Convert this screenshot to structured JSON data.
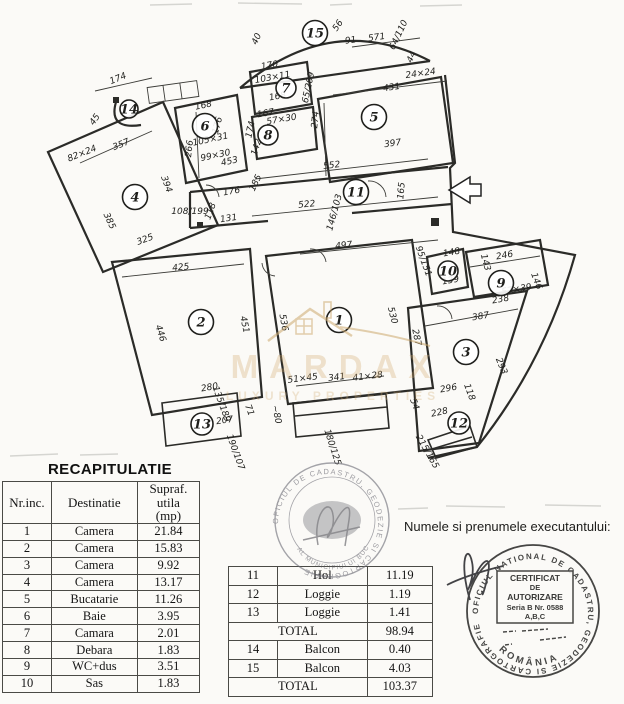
{
  "recap": {
    "title": "RECAPITULATIE",
    "headers": {
      "nr": "Nr.inc.",
      "dest": "Destinatie",
      "area": "Supraf. utila",
      "area_unit": "(mp)"
    },
    "left_rows": [
      {
        "nr": "1",
        "dest": "Camera",
        "val": "21.84"
      },
      {
        "nr": "2",
        "dest": "Camera",
        "val": "15.83"
      },
      {
        "nr": "3",
        "dest": "Camera",
        "val": "9.92"
      },
      {
        "nr": "4",
        "dest": "Camera",
        "val": "13.17"
      },
      {
        "nr": "5",
        "dest": "Bucatarie",
        "val": "11.26"
      },
      {
        "nr": "6",
        "dest": "Baie",
        "val": "3.95"
      },
      {
        "nr": "7",
        "dest": "Camara",
        "val": "2.01"
      },
      {
        "nr": "8",
        "dest": "Debara",
        "val": "1.83"
      },
      {
        "nr": "9",
        "dest": "WC+dus",
        "val": "3.51"
      },
      {
        "nr": "10",
        "dest": "Sas",
        "val": "1.83"
      }
    ],
    "right_rows": [
      {
        "nr": "11",
        "dest": "Hol",
        "val": "11.19"
      },
      {
        "nr": "12",
        "dest": "Loggie",
        "val": "1.19"
      },
      {
        "nr": "13",
        "dest": "Loggie",
        "val": "1.41"
      }
    ],
    "subtotal": {
      "label": "TOTAL",
      "val": "98.94"
    },
    "right_rows2": [
      {
        "nr": "14",
        "dest": "Balcon",
        "val": "0.40"
      },
      {
        "nr": "15",
        "dest": "Balcon",
        "val": "4.03"
      }
    ],
    "total": {
      "label": "TOTAL",
      "val": "103.37"
    }
  },
  "executor": {
    "label": "Numele si prenumele executantului:"
  },
  "watermark": {
    "brand": "MARDAX",
    "tagline": "LUXURY PROPERTIES"
  },
  "stamps": {
    "round1": {
      "ring": "OFICIUL DE CADASTRU, GEODEZIE SI CARTOGRAFIE",
      "inner": "AL MUNICIPIULUI BUCURESTI"
    },
    "round2": {
      "ring": "OFICIUL NATIONAL DE CADASTRU, GEODEZIE SI CARTOGRAFIE",
      "country": "ROMÂNIA",
      "cert_l1": "CERTIFICAT",
      "cert_l2": "DE",
      "cert_l3": "AUTORIZARE",
      "cert_l4": "Seria B Nr. 0588",
      "cert_l5": "A,B,C"
    }
  },
  "plan": {
    "rooms": [
      {
        "n": "1",
        "x": 339,
        "y": 320
      },
      {
        "n": "2",
        "x": 201,
        "y": 322
      },
      {
        "n": "3",
        "x": 466,
        "y": 352
      },
      {
        "n": "4",
        "x": 135,
        "y": 197
      },
      {
        "n": "5",
        "x": 374,
        "y": 117
      },
      {
        "n": "6",
        "x": 205,
        "y": 126
      },
      {
        "n": "7",
        "x": 286,
        "y": 88,
        "rr": 10
      },
      {
        "n": "8",
        "x": 268,
        "y": 135,
        "rr": 10
      },
      {
        "n": "9",
        "x": 501,
        "y": 283
      },
      {
        "n": "10",
        "x": 448,
        "y": 271,
        "rr": 10
      },
      {
        "n": "11",
        "x": 356,
        "y": 192
      },
      {
        "n": "12",
        "x": 459,
        "y": 423,
        "rr": 11
      },
      {
        "n": "13",
        "x": 202,
        "y": 424,
        "rr": 11
      },
      {
        "n": "14",
        "x": 129,
        "y": 109,
        "rr": 9
      },
      {
        "n": "15",
        "x": 315,
        "y": 33
      }
    ],
    "dim_labels": [
      {
        "t": "571",
        "x": 377,
        "y": 40,
        "r": -8
      },
      {
        "t": "56",
        "x": 340,
        "y": 27,
        "r": -55
      },
      {
        "t": "91",
        "x": 351,
        "y": 43,
        "r": -8,
        "s": 7
      },
      {
        "t": "64/110",
        "x": 401,
        "y": 36,
        "r": -65,
        "s": 6
      },
      {
        "t": "40",
        "x": 259,
        "y": 40,
        "r": -65,
        "s": 6
      },
      {
        "t": "44",
        "x": 414,
        "y": 58,
        "r": -65,
        "s": 6
      },
      {
        "t": "431",
        "x": 392,
        "y": 90,
        "r": -8
      },
      {
        "t": "24×24",
        "x": 421,
        "y": 76,
        "r": -8,
        "s": 6
      },
      {
        "t": "397",
        "x": 393,
        "y": 146,
        "r": -8
      },
      {
        "t": "274",
        "x": 318,
        "y": 120,
        "r": -84
      },
      {
        "t": "552",
        "x": 332,
        "y": 168,
        "r": -7
      },
      {
        "t": "65/209",
        "x": 311,
        "y": 88,
        "r": -78,
        "s": 6
      },
      {
        "t": "170",
        "x": 270,
        "y": 68,
        "r": -10,
        "s": 8
      },
      {
        "t": "103×11",
        "x": 273,
        "y": 80,
        "r": -10,
        "s": 5.5
      },
      {
        "t": "168",
        "x": 278,
        "y": 99,
        "r": -10,
        "s": 8
      },
      {
        "t": "167",
        "x": 266,
        "y": 116,
        "r": -10,
        "s": 8
      },
      {
        "t": "57×30",
        "x": 282,
        "y": 122,
        "r": -10,
        "s": 5.5
      },
      {
        "t": "174",
        "x": 253,
        "y": 130,
        "r": -78,
        "s": 7
      },
      {
        "t": "142",
        "x": 259,
        "y": 148,
        "r": -72,
        "s": 7
      },
      {
        "t": "168",
        "x": 204,
        "y": 108,
        "r": -12,
        "s": 8
      },
      {
        "t": "176",
        "x": 220,
        "y": 126,
        "r": -75,
        "s": 7
      },
      {
        "t": "266",
        "x": 192,
        "y": 149,
        "r": -83
      },
      {
        "t": "105×31",
        "x": 211,
        "y": 142,
        "r": -12,
        "s": 5.5
      },
      {
        "t": "99×30",
        "x": 216,
        "y": 158,
        "r": -12,
        "s": 5.5
      },
      {
        "t": "453",
        "x": 230,
        "y": 164,
        "r": -12,
        "s": 8
      },
      {
        "t": "176",
        "x": 232,
        "y": 194,
        "r": -10
      },
      {
        "t": "131",
        "x": 229,
        "y": 221,
        "r": -8
      },
      {
        "t": "118",
        "x": 213,
        "y": 212,
        "r": -70,
        "s": 8
      },
      {
        "t": "185",
        "x": 258,
        "y": 184,
        "r": -65,
        "s": 8
      },
      {
        "t": "108/199",
        "x": 190,
        "y": 214,
        "r": 0,
        "s": 6
      },
      {
        "t": "174",
        "x": 119,
        "y": 81,
        "r": -22
      },
      {
        "t": "45",
        "x": 97,
        "y": 121,
        "r": -55,
        "s": 8
      },
      {
        "t": "357",
        "x": 122,
        "y": 147,
        "r": -22
      },
      {
        "t": "82×24",
        "x": 83,
        "y": 156,
        "r": -22,
        "s": 6
      },
      {
        "t": "385",
        "x": 107,
        "y": 222,
        "r": 65
      },
      {
        "t": "325",
        "x": 146,
        "y": 242,
        "r": -20
      },
      {
        "t": "394",
        "x": 164,
        "y": 185,
        "r": 70
      },
      {
        "t": "522",
        "x": 307,
        "y": 207,
        "r": -6
      },
      {
        "t": "146/103",
        "x": 337,
        "y": 213,
        "r": -75,
        "s": 6
      },
      {
        "t": "497",
        "x": 344,
        "y": 248,
        "r": -6
      },
      {
        "t": "165",
        "x": 404,
        "y": 191,
        "r": -85,
        "s": 8
      },
      {
        "t": "95/151",
        "x": 421,
        "y": 262,
        "r": 70,
        "s": 6
      },
      {
        "t": "425",
        "x": 181,
        "y": 270,
        "r": -6
      },
      {
        "t": "446",
        "x": 158,
        "y": 334,
        "r": 72
      },
      {
        "t": "451",
        "x": 242,
        "y": 325,
        "r": 78
      },
      {
        "t": "536",
        "x": 281,
        "y": 323,
        "r": 80
      },
      {
        "t": "530",
        "x": 390,
        "y": 316,
        "r": 76
      },
      {
        "t": "341",
        "x": 337,
        "y": 380,
        "r": -7
      },
      {
        "t": "51×45",
        "x": 303,
        "y": 381,
        "r": -7,
        "s": 6
      },
      {
        "t": "41×28",
        "x": 368,
        "y": 379,
        "r": -7,
        "s": 6
      },
      {
        "t": "~80",
        "x": 274,
        "y": 415,
        "r": 78,
        "s": 7
      },
      {
        "t": "180/125",
        "x": 330,
        "y": 448,
        "r": 72,
        "s": 6
      },
      {
        "t": "280",
        "x": 210,
        "y": 390,
        "r": -10,
        "s": 8
      },
      {
        "t": "135/189",
        "x": 219,
        "y": 405,
        "r": 70,
        "s": 6
      },
      {
        "t": "207",
        "x": 225,
        "y": 423,
        "r": -8
      },
      {
        "t": "71",
        "x": 247,
        "y": 411,
        "r": 70,
        "s": 7
      },
      {
        "t": "190/107",
        "x": 233,
        "y": 453,
        "r": 70,
        "s": 6
      },
      {
        "t": "387",
        "x": 481,
        "y": 319,
        "r": -9
      },
      {
        "t": "287",
        "x": 414,
        "y": 338,
        "r": 78
      },
      {
        "t": "293",
        "x": 499,
        "y": 367,
        "r": 68
      },
      {
        "t": "296",
        "x": 449,
        "y": 391,
        "r": -10,
        "s": 8
      },
      {
        "t": "118",
        "x": 467,
        "y": 393,
        "r": 70,
        "s": 7
      },
      {
        "t": "54",
        "x": 412,
        "y": 405,
        "r": 70,
        "s": 7
      },
      {
        "t": "228",
        "x": 440,
        "y": 415,
        "r": -12,
        "s": 8
      },
      {
        "t": "215/165",
        "x": 425,
        "y": 453,
        "r": 60,
        "s": 6
      },
      {
        "t": "148",
        "x": 452,
        "y": 255,
        "r": -10,
        "s": 8
      },
      {
        "t": "246",
        "x": 505,
        "y": 258,
        "r": -10
      },
      {
        "t": "139",
        "x": 451,
        "y": 283,
        "r": -10,
        "s": 7
      },
      {
        "t": "143",
        "x": 483,
        "y": 263,
        "r": 75,
        "s": 7
      },
      {
        "t": "146",
        "x": 534,
        "y": 282,
        "r": 70,
        "s": 7
      },
      {
        "t": "238",
        "x": 501,
        "y": 302,
        "r": -10,
        "s": 8
      },
      {
        "t": "57×39",
        "x": 517,
        "y": 292,
        "r": -10,
        "s": 5.5
      }
    ]
  }
}
